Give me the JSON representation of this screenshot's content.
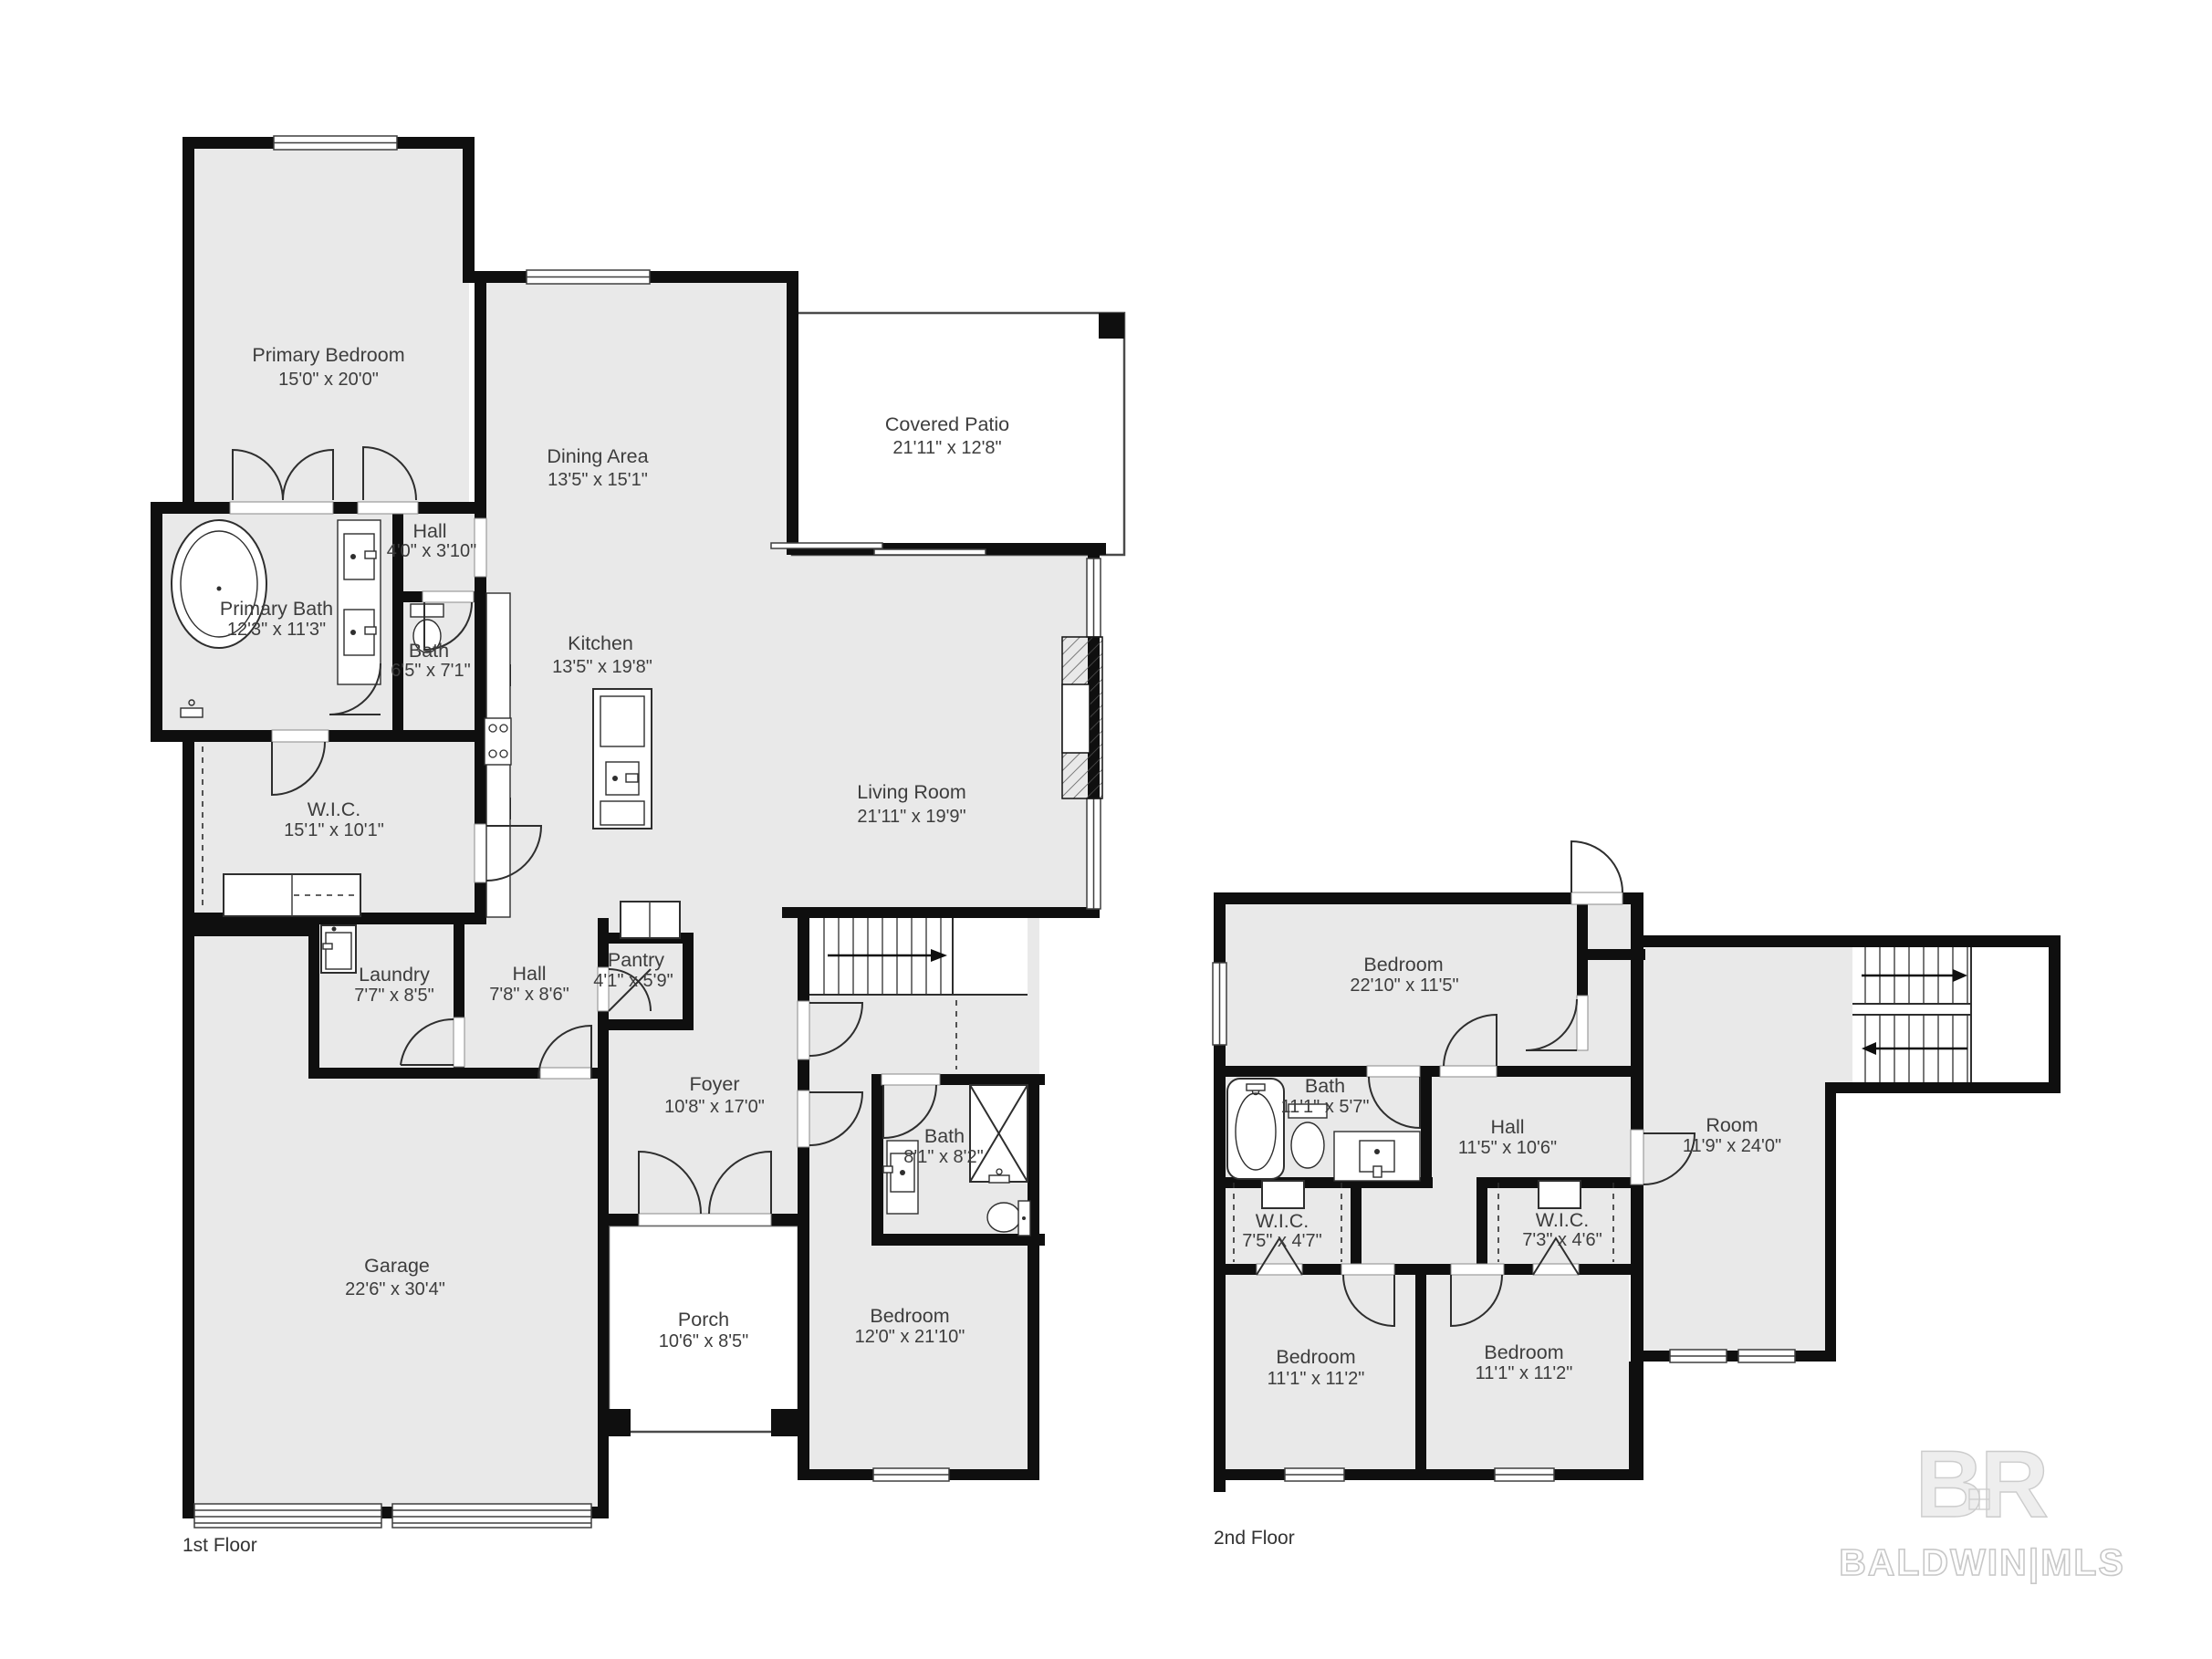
{
  "floor1": {
    "label": "1st Floor",
    "primary_bedroom": {
      "name": "Primary Bedroom",
      "dims": "15'0\" x 20'0\""
    },
    "dining": {
      "name": "Dining Area",
      "dims": "13'5\" x 15'1\""
    },
    "patio": {
      "name": "Covered Patio",
      "dims": "21'11\" x 12'8\""
    },
    "hall_small": {
      "name": "Hall",
      "dims": "4'0\" x 3'10\""
    },
    "primary_bath": {
      "name": "Primary Bath",
      "dims": "12'3\" x 11'3\""
    },
    "bath_small": {
      "name": "Bath",
      "dims": "6'5\" x 7'1\""
    },
    "kitchen": {
      "name": "Kitchen",
      "dims": "13'5\" x 19'8\""
    },
    "living": {
      "name": "Living Room",
      "dims": "21'11\" x 19'9\""
    },
    "wic": {
      "name": "W.I.C.",
      "dims": "15'1\" x 10'1\""
    },
    "laundry": {
      "name": "Laundry",
      "dims": "7'7\" x 8'5\""
    },
    "hall": {
      "name": "Hall",
      "dims": "7'8\" x 8'6\""
    },
    "pantry": {
      "name": "Pantry",
      "dims": "4'1\" x 5'9\""
    },
    "foyer": {
      "name": "Foyer",
      "dims": "10'8\" x 17'0\""
    },
    "bath": {
      "name": "Bath",
      "dims": "8'1\" x 8'2\""
    },
    "garage": {
      "name": "Garage",
      "dims": "22'6\" x 30'4\""
    },
    "porch": {
      "name": "Porch",
      "dims": "10'6\" x 8'5\""
    },
    "bedroom": {
      "name": "Bedroom",
      "dims": "12'0\" x 21'10\""
    }
  },
  "floor2": {
    "label": "2nd Floor",
    "bedroom_top": {
      "name": "Bedroom",
      "dims": "22'10\" x 11'5\""
    },
    "bath": {
      "name": "Bath",
      "dims": "11'1\" x 5'7\""
    },
    "hall": {
      "name": "Hall",
      "dims": "11'5\" x 10'6\""
    },
    "room": {
      "name": "Room",
      "dims": "11'9\" x 24'0\""
    },
    "wic_left": {
      "name": "W.I.C.",
      "dims": "7'5\" x 4'7\""
    },
    "wic_right": {
      "name": "W.I.C.",
      "dims": "7'3\" x 4'6\""
    },
    "bedroom_left": {
      "name": "Bedroom",
      "dims": "11'1\" x 11'2\""
    },
    "bedroom_right": {
      "name": "Bedroom",
      "dims": "11'1\" x 11'2\""
    }
  },
  "watermark": {
    "initials": "BR",
    "brand": "BALDWIN|MLS"
  },
  "colors": {
    "room_fill": "#e9e9e9",
    "wall": "#0f0f0f",
    "outdoor": "#ffffff",
    "text": "#3d3d3d",
    "watermark": "#d9d9d9"
  }
}
